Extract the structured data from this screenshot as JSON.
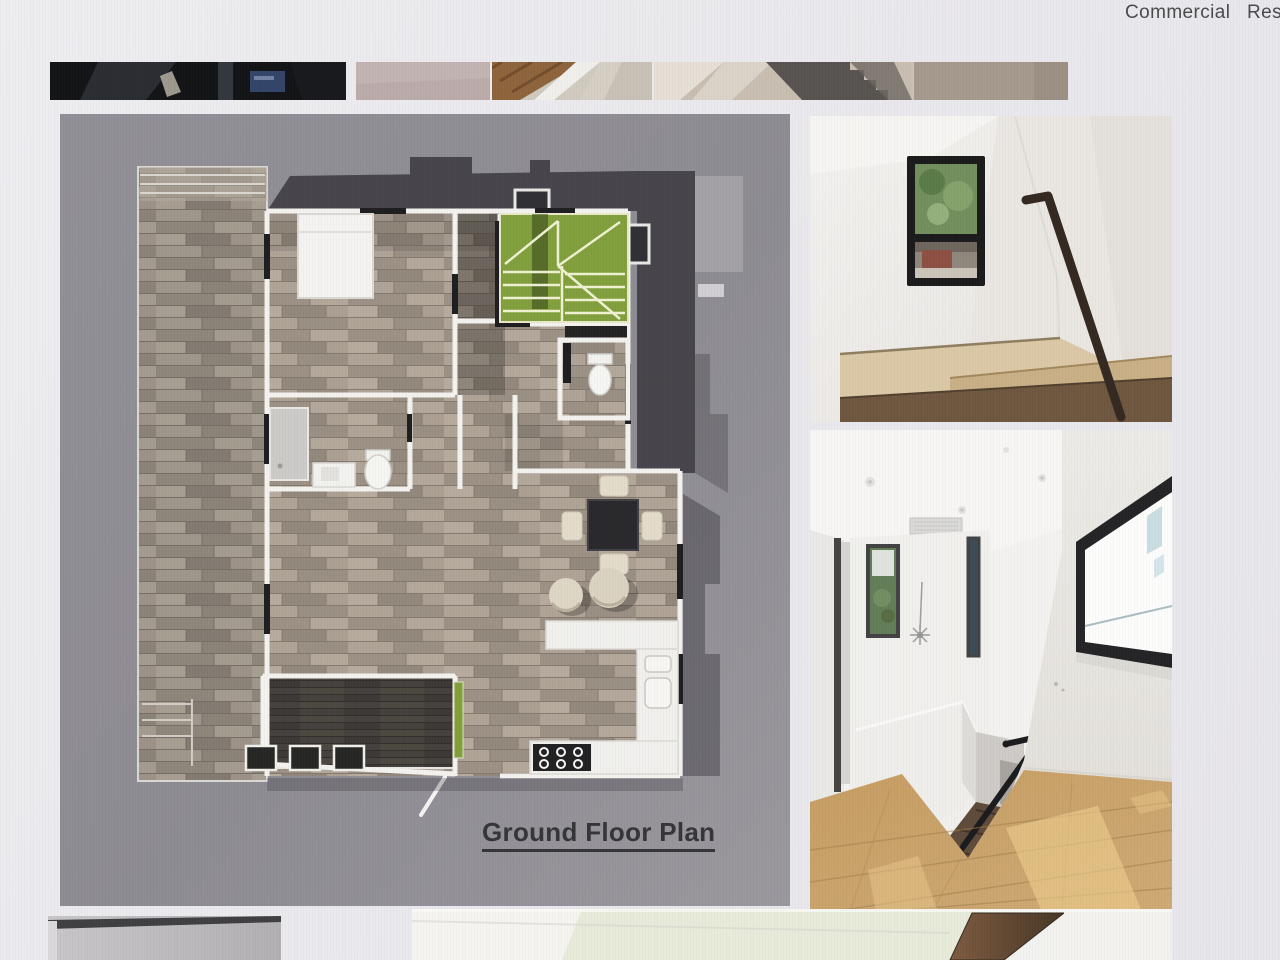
{
  "nav": {
    "items": [
      {
        "label": "Commercial"
      },
      {
        "label": "Residential"
      }
    ]
  },
  "plan": {
    "label": "Ground Floor Plan"
  },
  "gallery": {
    "top_thumbnails": [
      {
        "name": "dark-interior-photo"
      },
      {
        "name": "plain-mauve-wall-photo"
      },
      {
        "name": "wood-beam-and-carpet-photo"
      },
      {
        "name": "carpeted-stairs-photo"
      }
    ],
    "bottom_thumbnails": [
      {
        "name": "gray-wall-corner-photo"
      },
      {
        "name": "white-interior-with-wood-beam-photo"
      }
    ]
  },
  "photos": {
    "right_column": [
      {
        "name": "stairwell-window-photo"
      },
      {
        "name": "upstairs-hallway-photo"
      }
    ]
  },
  "colors": {
    "page_bg": "#eae9ec",
    "plan_bg": "#8b8990",
    "roof_dark": "#413f45",
    "stairs_green": "#7d9c35",
    "nav_text": "#454547",
    "label_text": "#2f2e31"
  }
}
